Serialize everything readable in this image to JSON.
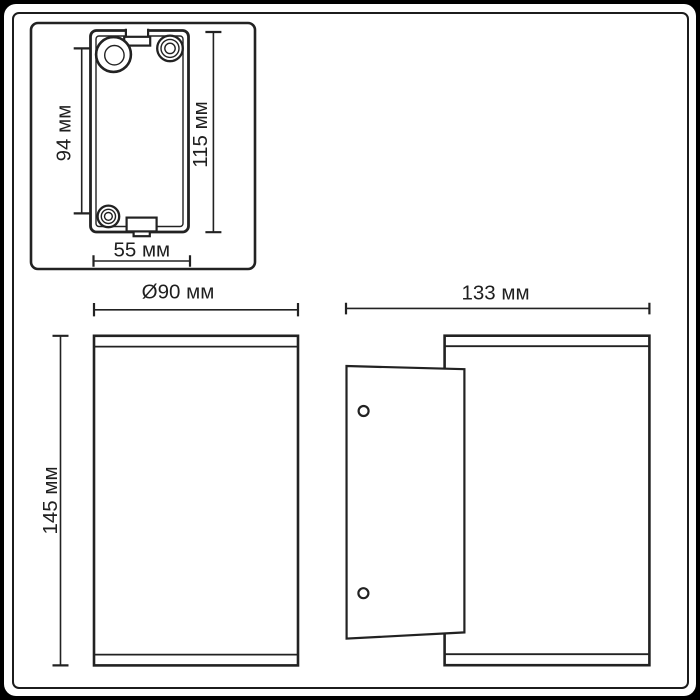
{
  "colors": {
    "background": "#000000",
    "paper": "#ffffff",
    "line": "#222222",
    "text": "#1f1f1f"
  },
  "drawing": {
    "detail_view": {
      "screw_spacing_label": "94 мм",
      "plate_height_label": "115 мм",
      "plate_width_label": "55 мм"
    },
    "front_view": {
      "diameter_label": "Ø90 мм",
      "height_label": "145 мм"
    },
    "side_view": {
      "depth_label": "133 мм"
    }
  }
}
